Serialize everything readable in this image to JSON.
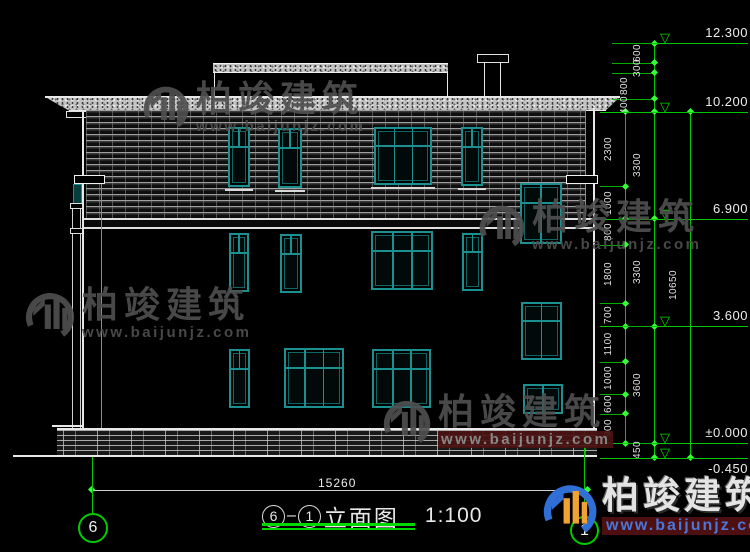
{
  "colors": {
    "cad_green": "#00c800",
    "teal": "#1a9090",
    "white_line": "#e8e8e8",
    "watermark_grey": "#4f4f4f",
    "brand_blue": "#2f6fd6",
    "brand_orange": "#f0a232",
    "maroon": "#4d0f0f"
  },
  "title": {
    "axis_from": "6",
    "dash": "—",
    "axis_to": "1",
    "name": "立面图",
    "scale": "1:100"
  },
  "bottom": {
    "width_dim": "15260",
    "axis_left_label": "6",
    "axis_right_label": "1"
  },
  "watermark": {
    "name": "柏竣建筑",
    "url": "www.baijunjz.com"
  },
  "brand": {
    "name": "柏竣建筑",
    "url": "www.baijunjz.com"
  },
  "dimensions": {
    "levels": [
      {
        "label": "12.300",
        "mm": 12300
      },
      {
        "label": "10.200",
        "mm": 10200
      },
      {
        "label": "6.900",
        "mm": 6900
      },
      {
        "label": "3.600",
        "mm": 3600
      },
      {
        "label": "±0.000",
        "mm": 0
      },
      {
        "label": "-0.450",
        "mm": -450
      }
    ],
    "chains": [
      {
        "name": "inner-chain",
        "x": 625,
        "start_mm": 10200,
        "segments": [
          2300,
          1000,
          800,
          1800,
          700,
          1100,
          1000,
          600,
          900
        ],
        "stagger": [
          0,
          0,
          0,
          0,
          0,
          0,
          0,
          0,
          0
        ]
      },
      {
        "name": "middle-chain",
        "x": 654,
        "start_mm": 12300,
        "segments": [
          600,
          300,
          800,
          400,
          3300,
          3300,
          3600,
          450
        ],
        "stagger": [
          0,
          0,
          1,
          1,
          0,
          0,
          0,
          0
        ]
      },
      {
        "name": "outer-chain",
        "x": 690,
        "start_mm": 10200,
        "segments": [
          10650
        ],
        "stagger": [
          0
        ]
      }
    ]
  },
  "building": {
    "windows": [
      {
        "x": 228,
        "y": 127,
        "w": 22,
        "h": 60,
        "style": "narrow",
        "sill": true
      },
      {
        "x": 278,
        "y": 128,
        "w": 24,
        "h": 60,
        "style": "narrow",
        "sill": true
      },
      {
        "x": 374,
        "y": 127,
        "w": 58,
        "h": 58,
        "style": "big",
        "sill": true
      },
      {
        "x": 461,
        "y": 127,
        "w": 22,
        "h": 59,
        "style": "narrow",
        "sill": true
      },
      {
        "x": 520,
        "y": 183,
        "w": 42,
        "h": 61,
        "style": "stair",
        "sill": false
      },
      {
        "x": 229,
        "y": 233,
        "w": 20,
        "h": 59,
        "style": "narrow",
        "sill": false
      },
      {
        "x": 280,
        "y": 234,
        "w": 22,
        "h": 59,
        "style": "narrow",
        "sill": false
      },
      {
        "x": 371,
        "y": 231,
        "w": 62,
        "h": 59,
        "style": "big",
        "sill": false
      },
      {
        "x": 462,
        "y": 233,
        "w": 21,
        "h": 58,
        "style": "narrow",
        "sill": false
      },
      {
        "x": 521,
        "y": 302,
        "w": 41,
        "h": 58,
        "style": "stair",
        "sill": false
      },
      {
        "x": 229,
        "y": 349,
        "w": 21,
        "h": 59,
        "style": "narrow",
        "sill": false
      },
      {
        "x": 284,
        "y": 348,
        "w": 60,
        "h": 60,
        "style": "big",
        "sill": false
      },
      {
        "x": 372,
        "y": 349,
        "w": 59,
        "h": 59,
        "style": "big",
        "sill": false
      },
      {
        "x": 523,
        "y": 384,
        "w": 40,
        "h": 30,
        "style": "small2",
        "sill": false
      }
    ]
  }
}
